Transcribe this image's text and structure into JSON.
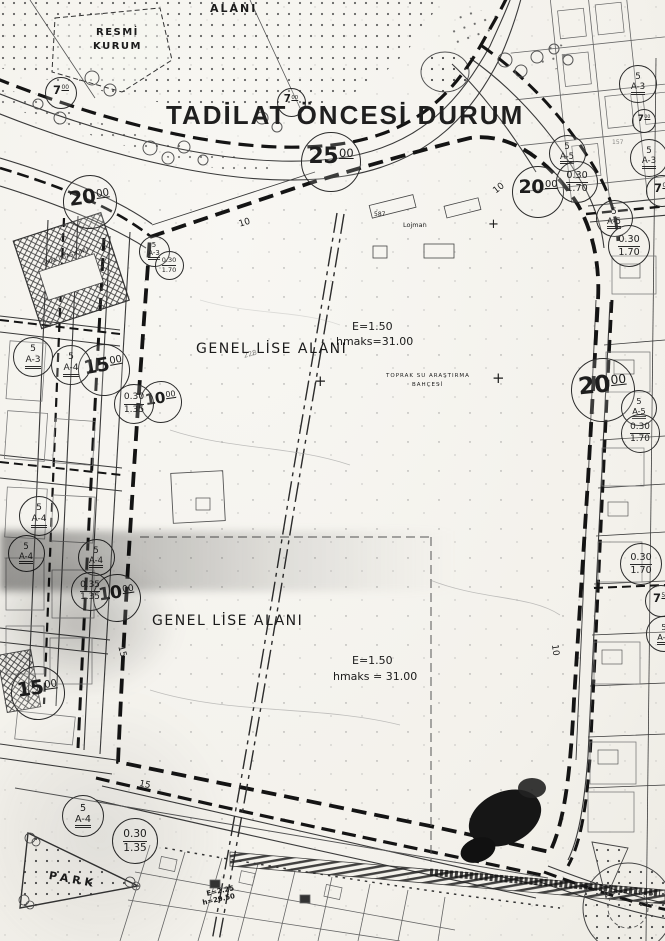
{
  "title": "TADİLAT ÖNCESİ DURUM",
  "map": {
    "colors": {
      "ink": "#1d1d1d",
      "paper": "#f5f4ef"
    },
    "labels": [
      {
        "text": "ALANI",
        "x": 210,
        "y": 3,
        "size": 11,
        "bold": true,
        "spacing": 2
      },
      {
        "text": "RESMİ",
        "x": 96,
        "y": 28,
        "size": 10,
        "bold": true,
        "spacing": 1.5
      },
      {
        "text": "KURUM",
        "x": 93,
        "y": 42,
        "size": 10,
        "bold": true,
        "spacing": 1.5
      },
      {
        "text": "GENEL LİSE ALANI",
        "x": 196,
        "y": 342,
        "size": 14,
        "spacing": 1.5
      },
      {
        "text": "E=1.50",
        "x": 352,
        "y": 321,
        "size": 11
      },
      {
        "text": "hmaks=31.00",
        "x": 336,
        "y": 336,
        "size": 11
      },
      {
        "text": "GENEL LİSE ALANI",
        "x": 152,
        "y": 614,
        "size": 14,
        "spacing": 1.5
      },
      {
        "text": "E=1.50",
        "x": 352,
        "y": 655,
        "size": 11
      },
      {
        "text": "hmaks = 31.00",
        "x": 333,
        "y": 671,
        "size": 11
      },
      {
        "text": "PARK",
        "x": 50,
        "y": 870,
        "size": 11,
        "bold": true,
        "spacing": 4,
        "rot": 10
      },
      {
        "text": "TOPRAK SU ARAŞTIRMA",
        "x": 386,
        "y": 374,
        "size": 5.5,
        "spacing": 1
      },
      {
        "text": "BAHÇESİ",
        "x": 412,
        "y": 383,
        "size": 5.5,
        "spacing": 1
      },
      {
        "text": "Lojman",
        "x": 403,
        "y": 222,
        "size": 6.5
      },
      {
        "text": "587",
        "x": 374,
        "y": 212,
        "size": 6
      },
      {
        "text": "E=2.25",
        "x": 206,
        "y": 891,
        "size": 7,
        "rot": -12,
        "bold": true
      },
      {
        "text": "h=29.50",
        "x": 202,
        "y": 900,
        "size": 7,
        "rot": -12,
        "bold": true
      },
      {
        "text": "İMAL İSTASYONU",
        "x": 44,
        "y": 262,
        "size": 5.5,
        "rot": -18
      },
      {
        "text": "+",
        "x": 314,
        "y": 374,
        "size": 15
      },
      {
        "text": "+",
        "x": 492,
        "y": 371,
        "size": 15
      },
      {
        "text": "+",
        "x": 488,
        "y": 218,
        "size": 13
      },
      {
        "text": "10",
        "x": 238,
        "y": 221,
        "size": 9,
        "rot": -17
      },
      {
        "text": "10",
        "x": 492,
        "y": 189,
        "size": 9,
        "rot": -38
      },
      {
        "text": "10",
        "x": 558,
        "y": 644,
        "size": 9,
        "rot": 83
      },
      {
        "text": "15",
        "x": 124,
        "y": 645,
        "size": 9,
        "rot": 75
      },
      {
        "text": "15",
        "x": 140,
        "y": 780,
        "size": 9,
        "rot": 12
      },
      {
        "text": "228",
        "x": 243,
        "y": 353,
        "size": 7,
        "rot": -15,
        "opacity": 0.55
      },
      {
        "text": "157",
        "x": 612,
        "y": 140,
        "size": 6,
        "opacity": 0.5
      }
    ],
    "circles": [
      {
        "kind": "width",
        "main": "7",
        "sup": "00",
        "x": 60,
        "y": 92,
        "d": 30
      },
      {
        "kind": "width",
        "main": "7",
        "sup": "00",
        "x": 290,
        "y": 101,
        "d": 27
      },
      {
        "kind": "width",
        "main": "25",
        "sup": "00",
        "x": 330,
        "y": 161,
        "d": 58
      },
      {
        "kind": "width",
        "main": "20",
        "sup": "00",
        "x": 537,
        "y": 191,
        "d": 50
      },
      {
        "kind": "width",
        "main": "20",
        "sup": "00",
        "x": 89,
        "y": 201,
        "d": 52,
        "rot": -8
      },
      {
        "kind": "width",
        "main": "20",
        "sup": "00",
        "x": 602,
        "y": 389,
        "d": 62,
        "rot": -6
      },
      {
        "kind": "width",
        "main": "15",
        "sup": "00",
        "x": 103,
        "y": 369,
        "d": 50,
        "rot": -10
      },
      {
        "kind": "width",
        "main": "10",
        "sup": "00",
        "x": 160,
        "y": 401,
        "d": 40,
        "rot": -8
      },
      {
        "kind": "width",
        "main": "10",
        "sup": "00",
        "x": 116,
        "y": 597,
        "d": 46,
        "rot": -8
      },
      {
        "kind": "width",
        "main": "15",
        "sup": "00",
        "x": 37,
        "y": 692,
        "d": 52,
        "rot": -8
      },
      {
        "kind": "width",
        "main": "7",
        "sup": "00",
        "x": 643,
        "y": 120,
        "d": 22
      },
      {
        "kind": "width",
        "main": "7",
        "sup": "50",
        "x": 660,
        "y": 600,
        "d": 30
      },
      {
        "kind": "width",
        "main": "7",
        "sup": "00",
        "x": 661,
        "y": 190,
        "d": 30
      },
      {
        "kind": "zoning",
        "top": "5",
        "bottom": "A-3",
        "x": 32,
        "y": 356,
        "d": 38
      },
      {
        "kind": "zoning",
        "top": "5",
        "bottom": "A-4",
        "x": 70,
        "y": 364,
        "d": 38
      },
      {
        "kind": "zoning",
        "top": "5",
        "bottom": "A-4",
        "x": 38,
        "y": 515,
        "d": 38
      },
      {
        "kind": "zoning",
        "top": "5",
        "bottom": "A-4",
        "x": 25,
        "y": 552,
        "d": 35
      },
      {
        "kind": "zoning",
        "top": "5",
        "bottom": "A-4",
        "x": 95,
        "y": 556,
        "d": 35
      },
      {
        "kind": "zoning",
        "top": "5",
        "bottom": "A-4",
        "x": 82,
        "y": 815,
        "d": 40
      },
      {
        "kind": "zoning",
        "top": "5",
        "bottom": "A-3",
        "x": 637,
        "y": 83,
        "d": 36
      },
      {
        "kind": "zoning",
        "top": "5",
        "bottom": "A-3",
        "x": 648,
        "y": 157,
        "d": 36
      },
      {
        "kind": "zoning",
        "top": "5",
        "bottom": "A-5",
        "x": 566,
        "y": 152,
        "d": 35
      },
      {
        "kind": "zoning",
        "top": "5",
        "bottom": "A-5",
        "x": 613,
        "y": 217,
        "d": 35
      },
      {
        "kind": "zoning",
        "top": "5",
        "bottom": "A-5",
        "x": 638,
        "y": 407,
        "d": 34
      },
      {
        "kind": "zoning",
        "top": "5",
        "bottom": "A-3",
        "x": 153,
        "y": 250,
        "d": 29
      },
      {
        "kind": "zoning",
        "top": "5",
        "bottom": "A-5",
        "x": 663,
        "y": 633,
        "d": 34
      },
      {
        "kind": "ratio",
        "top": "0.30",
        "bottom": "1.35",
        "x": 133,
        "y": 403,
        "d": 38
      },
      {
        "kind": "ratio",
        "top": "0.35",
        "bottom": "1.35",
        "x": 89,
        "y": 590,
        "d": 37
      },
      {
        "kind": "ratio",
        "top": "0.30",
        "bottom": "1.35",
        "x": 134,
        "y": 840,
        "d": 44
      },
      {
        "kind": "ratio",
        "top": "0.30",
        "bottom": "1.70",
        "x": 576,
        "y": 181,
        "d": 40
      },
      {
        "kind": "ratio",
        "top": "0.30",
        "bottom": "1.70",
        "x": 628,
        "y": 245,
        "d": 40
      },
      {
        "kind": "ratio",
        "top": "0.30",
        "bottom": "1.70",
        "x": 639,
        "y": 432,
        "d": 37
      },
      {
        "kind": "ratio",
        "top": "0.30",
        "bottom": "1.70",
        "x": 640,
        "y": 563,
        "d": 40
      },
      {
        "kind": "ratio",
        "top": "0.30",
        "bottom": "1.70",
        "x": 168,
        "y": 264,
        "d": 27
      }
    ]
  }
}
